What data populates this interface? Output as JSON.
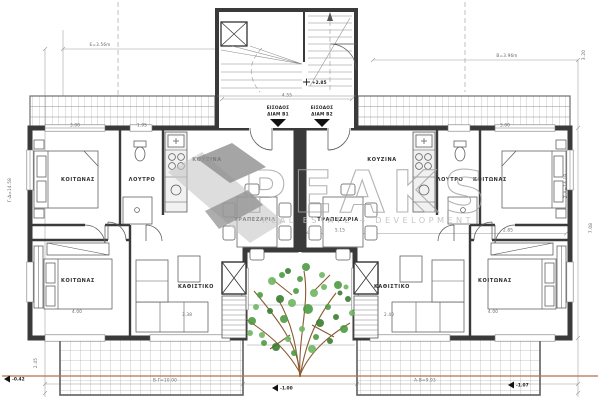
{
  "watermark": {
    "brand": "PEAKS",
    "tagline": "REAL ESTATE + DEVELOPMENT"
  },
  "core": {
    "entrance1_line1": "ΕΙΣΟΔΟΣ",
    "entrance1_line2": "ΔΙΑΜ Β1",
    "entrance2_line1": "ΕΙΣΟΔΟΣ",
    "entrance2_line2": "ΔΙΑΜ Β2",
    "hall_width": "4.55"
  },
  "left": {
    "bedroom_top": "ΚΟΙΤΩΝΑΣ",
    "bathroom": "ΛΟΥΤΡΟ",
    "kitchen": "ΚΟΥΖΙΝΑ",
    "dining": "ΤΡΑΠΕΖΑΡΙΑ",
    "bedroom_bottom": "ΚΟΙΤΩΝΑΣ",
    "living": "ΚΑΘΙΣΤΙΚΟ"
  },
  "right": {
    "bedroom_top": "ΚΟΙΤΩΝΑΣ",
    "bathroom": "ΛΟΥΤΡΟ",
    "kitchen": "ΚΟΥΖΙΝΑ",
    "dining": "ΤΡΑΠΕΖΑΡΙΑ",
    "bedroom_bottom": "ΚΟΙΤΩΝΑΣ",
    "living": "ΚΑΘΙΣΤΙΚΟ"
  },
  "dims": {
    "top_left": "Ε=3.56m",
    "top_right": "Β=3.96m",
    "left_edge": "Γ-Δ=14.58",
    "right_edge": "Ζ-Α=14.19",
    "right_upper": "3.20",
    "right_lower": "7.08",
    "terrace_left": "2.45",
    "bottom_left": "Β-Γ=10.00",
    "bottom_right": "Α-Β=9.93",
    "bed1_left": "3.00",
    "bath_left": "1.95",
    "bed2_left": "4.00",
    "living_left": "3.38",
    "bed1_right": "3.00",
    "bed2_right": "4.00",
    "living_right": "2.40",
    "width_right": "5.15",
    "diag_right": "2.85"
  },
  "levels": {
    "hall": "+2.85",
    "terrace_left": "-0.42",
    "garden": "-1.00",
    "terrace_right": "-1.07"
  },
  "colors": {
    "wall": "#3a3a3a",
    "dimension": "#9a9a9a",
    "watermark": "#a6a6a6",
    "logo_dark": "#8f8f8f",
    "logo_light": "#c6c6c6",
    "tree_leaf": "#4e9b43",
    "tree_branch": "#8a5a33",
    "boundary_line": "#b5714a"
  }
}
